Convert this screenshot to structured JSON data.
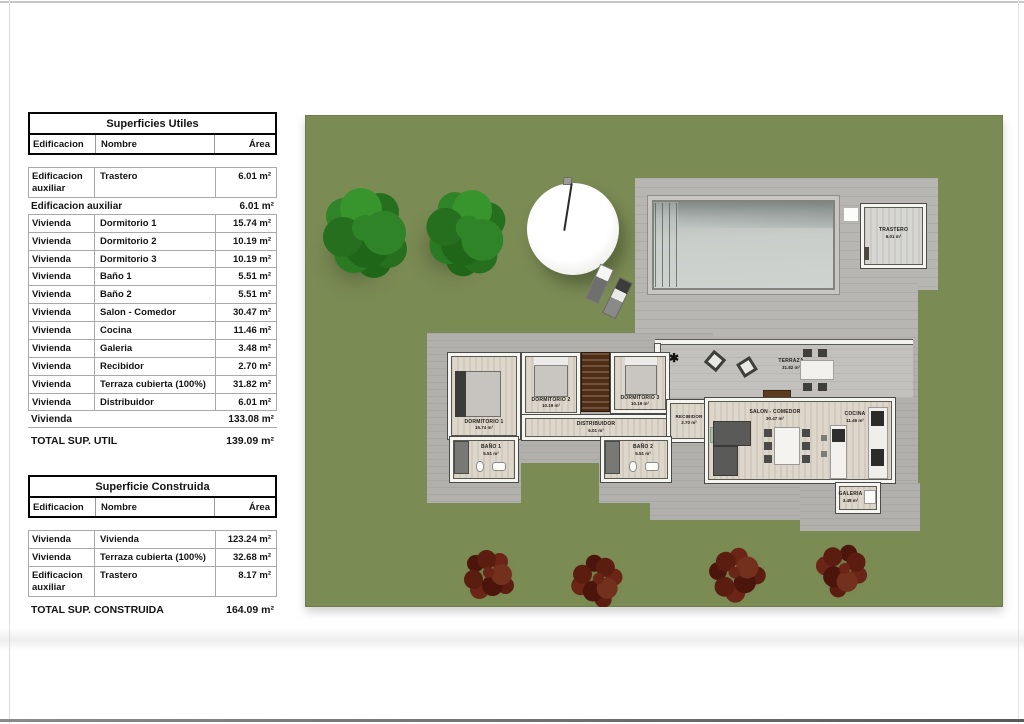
{
  "tables": {
    "utiles": {
      "title": "Superficies Utiles",
      "col_edificacion": "Edificacion",
      "col_nombre": "Nombre",
      "col_area": "Área",
      "rows": [
        {
          "edificacion": "Edificacion auxiliar",
          "nombre": "Trastero",
          "area": "6.01 m²"
        },
        {
          "edificacion": "Vivienda",
          "nombre": "Dormitorio 1",
          "area": "15.74 m²"
        },
        {
          "edificacion": "Vivienda",
          "nombre": "Dormitorio 2",
          "area": "10.19 m²"
        },
        {
          "edificacion": "Vivienda",
          "nombre": "Dormitorio 3",
          "area": "10.19 m²"
        },
        {
          "edificacion": "Vivienda",
          "nombre": "Baño 1",
          "area": "5.51 m²"
        },
        {
          "edificacion": "Vivienda",
          "nombre": "Baño 2",
          "area": "5.51 m²"
        },
        {
          "edificacion": "Vivienda",
          "nombre": "Salon - Comedor",
          "area": "30.47 m²"
        },
        {
          "edificacion": "Vivienda",
          "nombre": "Cocina",
          "area": "11.46 m²"
        },
        {
          "edificacion": "Vivienda",
          "nombre": "Galeria",
          "area": "3.48 m²"
        },
        {
          "edificacion": "Vivienda",
          "nombre": "Recibidor",
          "area": "2.70 m²"
        },
        {
          "edificacion": "Vivienda",
          "nombre": "Terraza cubierta (100%)",
          "area": "31.82 m²"
        },
        {
          "edificacion": "Vivienda",
          "nombre": "Distribuidor",
          "area": "6.01 m²"
        }
      ],
      "subtotal_aux_label": "Edificacion auxiliar",
      "subtotal_aux_value": "6.01 m²",
      "subtotal_viv_label": "Vivienda",
      "subtotal_viv_value": "133.08 m²",
      "total_label": "TOTAL SUP. UTIL",
      "total_value": "139.09 m²"
    },
    "construida": {
      "title": "Superficie Construida",
      "col_edificacion": "Edificacion",
      "col_nombre": "Nombre",
      "col_area": "Área",
      "rows": [
        {
          "edificacion": "Vivienda",
          "nombre": "Vivienda",
          "area": "123.24 m²"
        },
        {
          "edificacion": "Vivienda",
          "nombre": "Terraza cubierta (100%)",
          "area": "32.68 m²"
        },
        {
          "edificacion": "Edificacion auxiliar",
          "nombre": "Trastero",
          "area": "8.17 m²"
        }
      ],
      "total_label": "TOTAL SUP. CONSTRUIDA",
      "total_value": "164.09 m²"
    }
  },
  "plan": {
    "rooms": {
      "dormitorio1": {
        "name": "DORMITORIO 1",
        "area": "15.74 m²"
      },
      "dormitorio2": {
        "name": "DORMITORIO 2",
        "area": "10.19 m²"
      },
      "dormitorio3": {
        "name": "DORMITORIO 3",
        "area": "10.19 m²"
      },
      "distribuidor": {
        "name": "DISTRIBUIDOR",
        "area": "6.01 m²"
      },
      "recibidor": {
        "name": "RECIBIDOR",
        "area": "2.70 m²"
      },
      "bano1": {
        "name": "BAÑO 1",
        "area": "5.51 m²"
      },
      "bano2": {
        "name": "BAÑO 2",
        "area": "5.51 m²"
      },
      "salon": {
        "name": "SALON - COMEDOR",
        "area": "30.47 m²"
      },
      "cocina": {
        "name": "COCINA",
        "area": "11.46 m²"
      },
      "galeria": {
        "name": "GALERIA",
        "area": "3.48 m²"
      },
      "terraza": {
        "name": "TERRAZA",
        "area": "31.82 m²"
      },
      "trastero": {
        "name": "TRASTERO",
        "area": "6.01 m²"
      }
    },
    "colors": {
      "lawn": "#7b8b54",
      "deck": "#b7b6b3",
      "room_floor": "#ddd6ca",
      "pool_water": "#c9cecb",
      "tree_green": "#2f8428",
      "tree_red": "#6b2517"
    }
  }
}
